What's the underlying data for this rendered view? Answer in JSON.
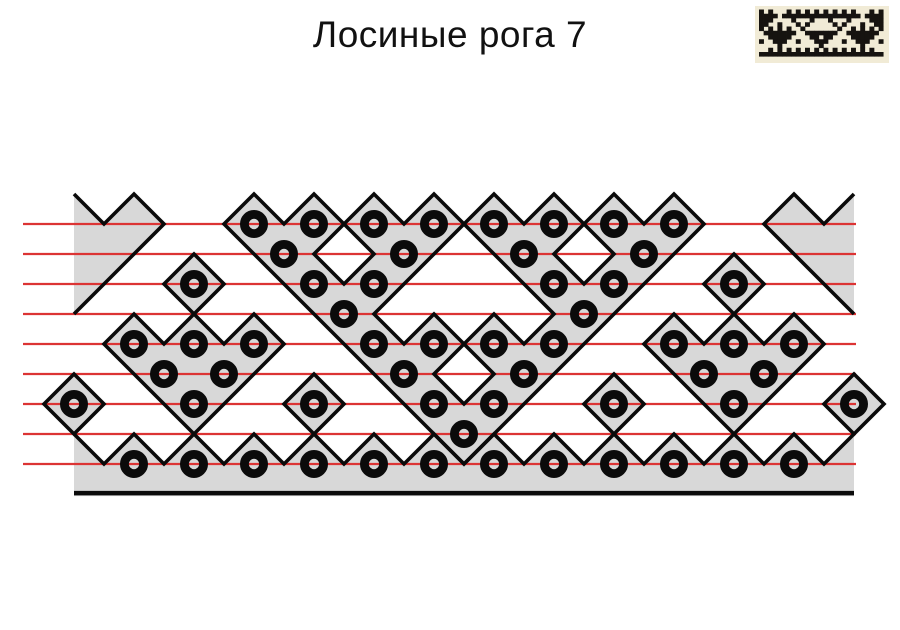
{
  "title": "Лосиные рога 7",
  "colors": {
    "background": "#ffffff",
    "shape_fill": "#d8d8d8",
    "outline": "#0b0b0b",
    "red_line": "#dc3434",
    "ring": "#0b0b0b",
    "thumb_bg": "#f1ebd6",
    "thumb_ink": "#161310",
    "title_color": "#111111"
  },
  "ornament": {
    "grid": {
      "origin_x": 74,
      "origin_y": 224,
      "unit": 30,
      "outline_width": 3.6
    },
    "red_lines": {
      "y_units": [
        0,
        1,
        2,
        3,
        4,
        5,
        6,
        7,
        8
      ],
      "x_start": 23,
      "x_end": 856,
      "width": 2.2
    },
    "baseline": {
      "y_unit": 8.97,
      "x_start_unit": 0,
      "x_end_unit": 26,
      "width": 4.5
    },
    "shapes": [
      {
        "name": "left-chevron",
        "points": [
          [
            0,
            -1
          ],
          [
            1,
            0
          ],
          [
            2,
            -1
          ],
          [
            3,
            0
          ],
          [
            0,
            3
          ]
        ],
        "stroke_closed": false,
        "stroke_count": 5
      },
      {
        "name": "right-chevron",
        "points": [
          [
            26,
            -1
          ],
          [
            25,
            0
          ],
          [
            24,
            -1
          ],
          [
            23,
            0
          ],
          [
            26,
            3
          ]
        ],
        "stroke_closed": false,
        "stroke_count": 5
      },
      {
        "name": "top-antler-band",
        "points": [
          [
            5,
            0
          ],
          [
            6,
            -1
          ],
          [
            7,
            0
          ],
          [
            8,
            -1
          ],
          [
            9,
            0
          ],
          [
            10,
            -1
          ],
          [
            11,
            0
          ],
          [
            12,
            -1
          ],
          [
            13,
            0
          ],
          [
            12,
            1
          ],
          [
            11,
            2
          ],
          [
            10,
            3
          ],
          [
            11,
            4
          ],
          [
            12,
            3
          ],
          [
            13,
            4
          ],
          [
            14,
            3
          ],
          [
            15,
            4
          ],
          [
            16,
            3
          ],
          [
            15,
            2
          ],
          [
            14,
            1
          ],
          [
            13,
            0
          ],
          [
            14,
            -1
          ],
          [
            15,
            0
          ],
          [
            16,
            -1
          ],
          [
            17,
            0
          ],
          [
            18,
            -1
          ],
          [
            19,
            0
          ],
          [
            20,
            -1
          ],
          [
            21,
            0
          ],
          [
            20,
            1
          ],
          [
            19,
            2
          ],
          [
            18,
            3
          ],
          [
            17,
            4
          ],
          [
            16,
            5
          ],
          [
            15,
            6
          ],
          [
            14,
            7
          ],
          [
            13,
            8
          ],
          [
            12,
            7
          ],
          [
            11,
            6
          ],
          [
            10,
            5
          ],
          [
            9,
            4
          ],
          [
            8,
            3
          ],
          [
            7,
            2
          ],
          [
            6,
            1
          ]
        ],
        "holes": [
          [
            [
              8,
              1
            ],
            [
              9,
              0
            ],
            [
              10,
              1
            ],
            [
              9,
              2
            ]
          ],
          [
            [
              16,
              1
            ],
            [
              17,
              0
            ],
            [
              18,
              1
            ],
            [
              17,
              2
            ]
          ],
          [
            [
              12,
              5
            ],
            [
              13,
              4
            ],
            [
              14,
              5
            ],
            [
              13,
              6
            ]
          ]
        ],
        "stroke_closed": true
      },
      {
        "name": "left-triangle",
        "points": [
          [
            1,
            4
          ],
          [
            2,
            3
          ],
          [
            3,
            4
          ],
          [
            4,
            3
          ],
          [
            5,
            4
          ],
          [
            6,
            3
          ],
          [
            7,
            4
          ],
          [
            6,
            5
          ],
          [
            5,
            6
          ],
          [
            4,
            7
          ],
          [
            3,
            6
          ],
          [
            2,
            5
          ]
        ],
        "stroke_closed": true
      },
      {
        "name": "right-triangle",
        "points": [
          [
            19,
            4
          ],
          [
            20,
            3
          ],
          [
            21,
            4
          ],
          [
            22,
            3
          ],
          [
            23,
            4
          ],
          [
            24,
            3
          ],
          [
            25,
            4
          ],
          [
            24,
            5
          ],
          [
            23,
            6
          ],
          [
            22,
            7
          ],
          [
            21,
            6
          ],
          [
            20,
            5
          ]
        ],
        "stroke_closed": true
      },
      {
        "name": "bottom-strip",
        "points": [
          [
            0,
            7
          ],
          [
            1,
            8
          ],
          [
            2,
            7
          ],
          [
            3,
            8
          ],
          [
            4,
            7
          ],
          [
            5,
            8
          ],
          [
            6,
            7
          ],
          [
            7,
            8
          ],
          [
            8,
            7
          ],
          [
            9,
            8
          ],
          [
            10,
            7
          ],
          [
            11,
            8
          ],
          [
            12,
            7
          ],
          [
            13,
            8
          ],
          [
            14,
            7
          ],
          [
            15,
            8
          ],
          [
            16,
            7
          ],
          [
            17,
            8
          ],
          [
            18,
            7
          ],
          [
            19,
            8
          ],
          [
            20,
            7
          ],
          [
            21,
            8
          ],
          [
            22,
            7
          ],
          [
            23,
            8
          ],
          [
            24,
            7
          ],
          [
            25,
            8
          ],
          [
            26,
            7
          ],
          [
            26,
            9.07
          ],
          [
            0,
            9.07
          ]
        ],
        "stroke_closed": false,
        "stroke_count": 27
      }
    ],
    "single_diamonds": [
      [
        4,
        2
      ],
      [
        22,
        2
      ],
      [
        0,
        6
      ],
      [
        8,
        6
      ],
      [
        18,
        6
      ],
      [
        26,
        6
      ]
    ],
    "rings": {
      "radius": 9.6,
      "stroke_width": 8.8,
      "positions": [
        [
          6,
          0
        ],
        [
          8,
          0
        ],
        [
          10,
          0
        ],
        [
          12,
          0
        ],
        [
          14,
          0
        ],
        [
          16,
          0
        ],
        [
          18,
          0
        ],
        [
          20,
          0
        ],
        [
          7,
          1
        ],
        [
          11,
          1
        ],
        [
          15,
          1
        ],
        [
          19,
          1
        ],
        [
          4,
          2
        ],
        [
          8,
          2
        ],
        [
          10,
          2
        ],
        [
          16,
          2
        ],
        [
          18,
          2
        ],
        [
          22,
          2
        ],
        [
          9,
          3
        ],
        [
          17,
          3
        ],
        [
          2,
          4
        ],
        [
          4,
          4
        ],
        [
          6,
          4
        ],
        [
          10,
          4
        ],
        [
          12,
          4
        ],
        [
          14,
          4
        ],
        [
          16,
          4
        ],
        [
          20,
          4
        ],
        [
          22,
          4
        ],
        [
          24,
          4
        ],
        [
          3,
          5
        ],
        [
          5,
          5
        ],
        [
          11,
          5
        ],
        [
          15,
          5
        ],
        [
          21,
          5
        ],
        [
          23,
          5
        ],
        [
          0,
          6
        ],
        [
          4,
          6
        ],
        [
          8,
          6
        ],
        [
          12,
          6
        ],
        [
          14,
          6
        ],
        [
          18,
          6
        ],
        [
          22,
          6
        ],
        [
          26,
          6
        ],
        [
          13,
          7
        ],
        [
          2,
          8
        ],
        [
          4,
          8
        ],
        [
          6,
          8
        ],
        [
          8,
          8
        ],
        [
          10,
          8
        ],
        [
          12,
          8
        ],
        [
          14,
          8
        ],
        [
          16,
          8
        ],
        [
          18,
          8
        ],
        [
          20,
          8
        ],
        [
          22,
          8
        ],
        [
          24,
          8
        ]
      ]
    }
  },
  "thumbnail": {
    "width": 134,
    "height": 57,
    "cell_w": 4.6,
    "cell_h": 4.25,
    "pad_x": 4,
    "pad_y": 3.5,
    "bitmap": [
      "#.#...#.#.#.#.#.#.#.#...#.#",
      "####.#################.####",
      "###....#...#...#...#....###",
      "##..#...#.#.....#.#...#..##",
      "#.#.#.#..#.......#..#.#.#.#",
      ".#######..#######..#######.",
      "..#####....##.##....#####..",
      "#..###..#...###...#..###..#",
      "....#........#........#....",
      "..#.#.#.#.#.#.#.#.#.#.#.#..",
      "###########################"
    ]
  }
}
